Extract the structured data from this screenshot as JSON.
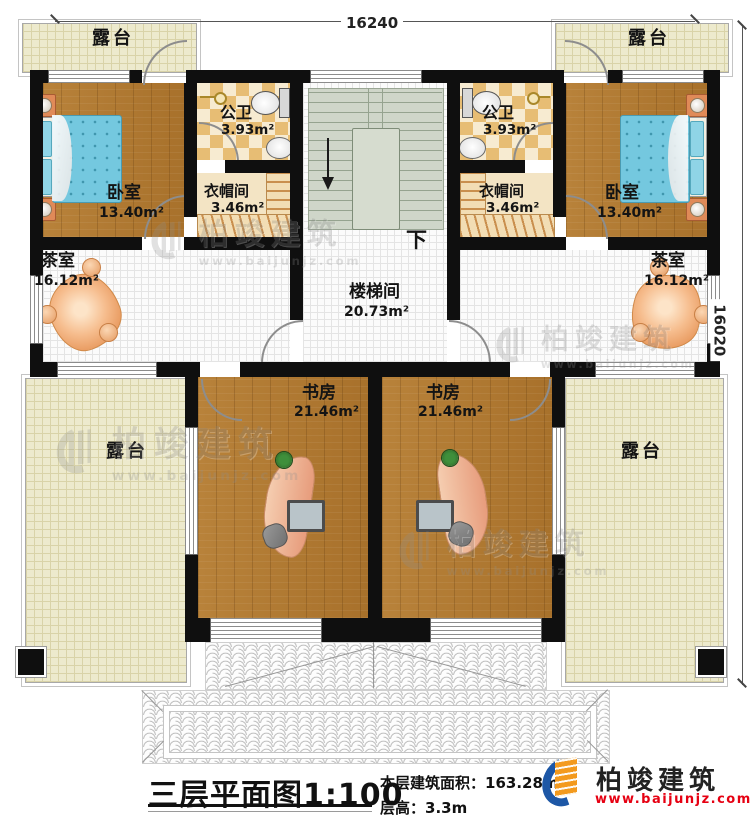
{
  "dimensions": {
    "top": "16240",
    "right": "16020"
  },
  "rooms": {
    "terrace": "露台",
    "bedroom": "卧室",
    "bedroom_area": "13.40m²",
    "bathroom": "公卫",
    "bathroom_area": "3.93m²",
    "cloakroom": "衣帽间",
    "cloakroom_area": "3.46m²",
    "tearoom": "茶室",
    "tearoom_area": "16.12m²",
    "stairwell": "楼梯间",
    "stairwell_area": "20.73m²",
    "study": "书房",
    "study_area": "21.46m²",
    "down": "下"
  },
  "watermark": {
    "brand": "柏竣建筑",
    "site": "www.baijunjz.com"
  },
  "footer": {
    "title": "三层平面图",
    "scale": "1:100",
    "area_label": "本层建筑面积：",
    "area_value": "163.28m²",
    "height_label": "层高：",
    "height_value": "3.3m",
    "brand": "柏竣建筑",
    "site": "www.baijunjz.com"
  },
  "colors": {
    "wall": "#0f0f0f",
    "wood": "#b0792f",
    "stair": "#cfd6c9",
    "brand_blue": "#1d57a6",
    "brand_orange": "#f39a1e",
    "site_red": "#e60012"
  }
}
